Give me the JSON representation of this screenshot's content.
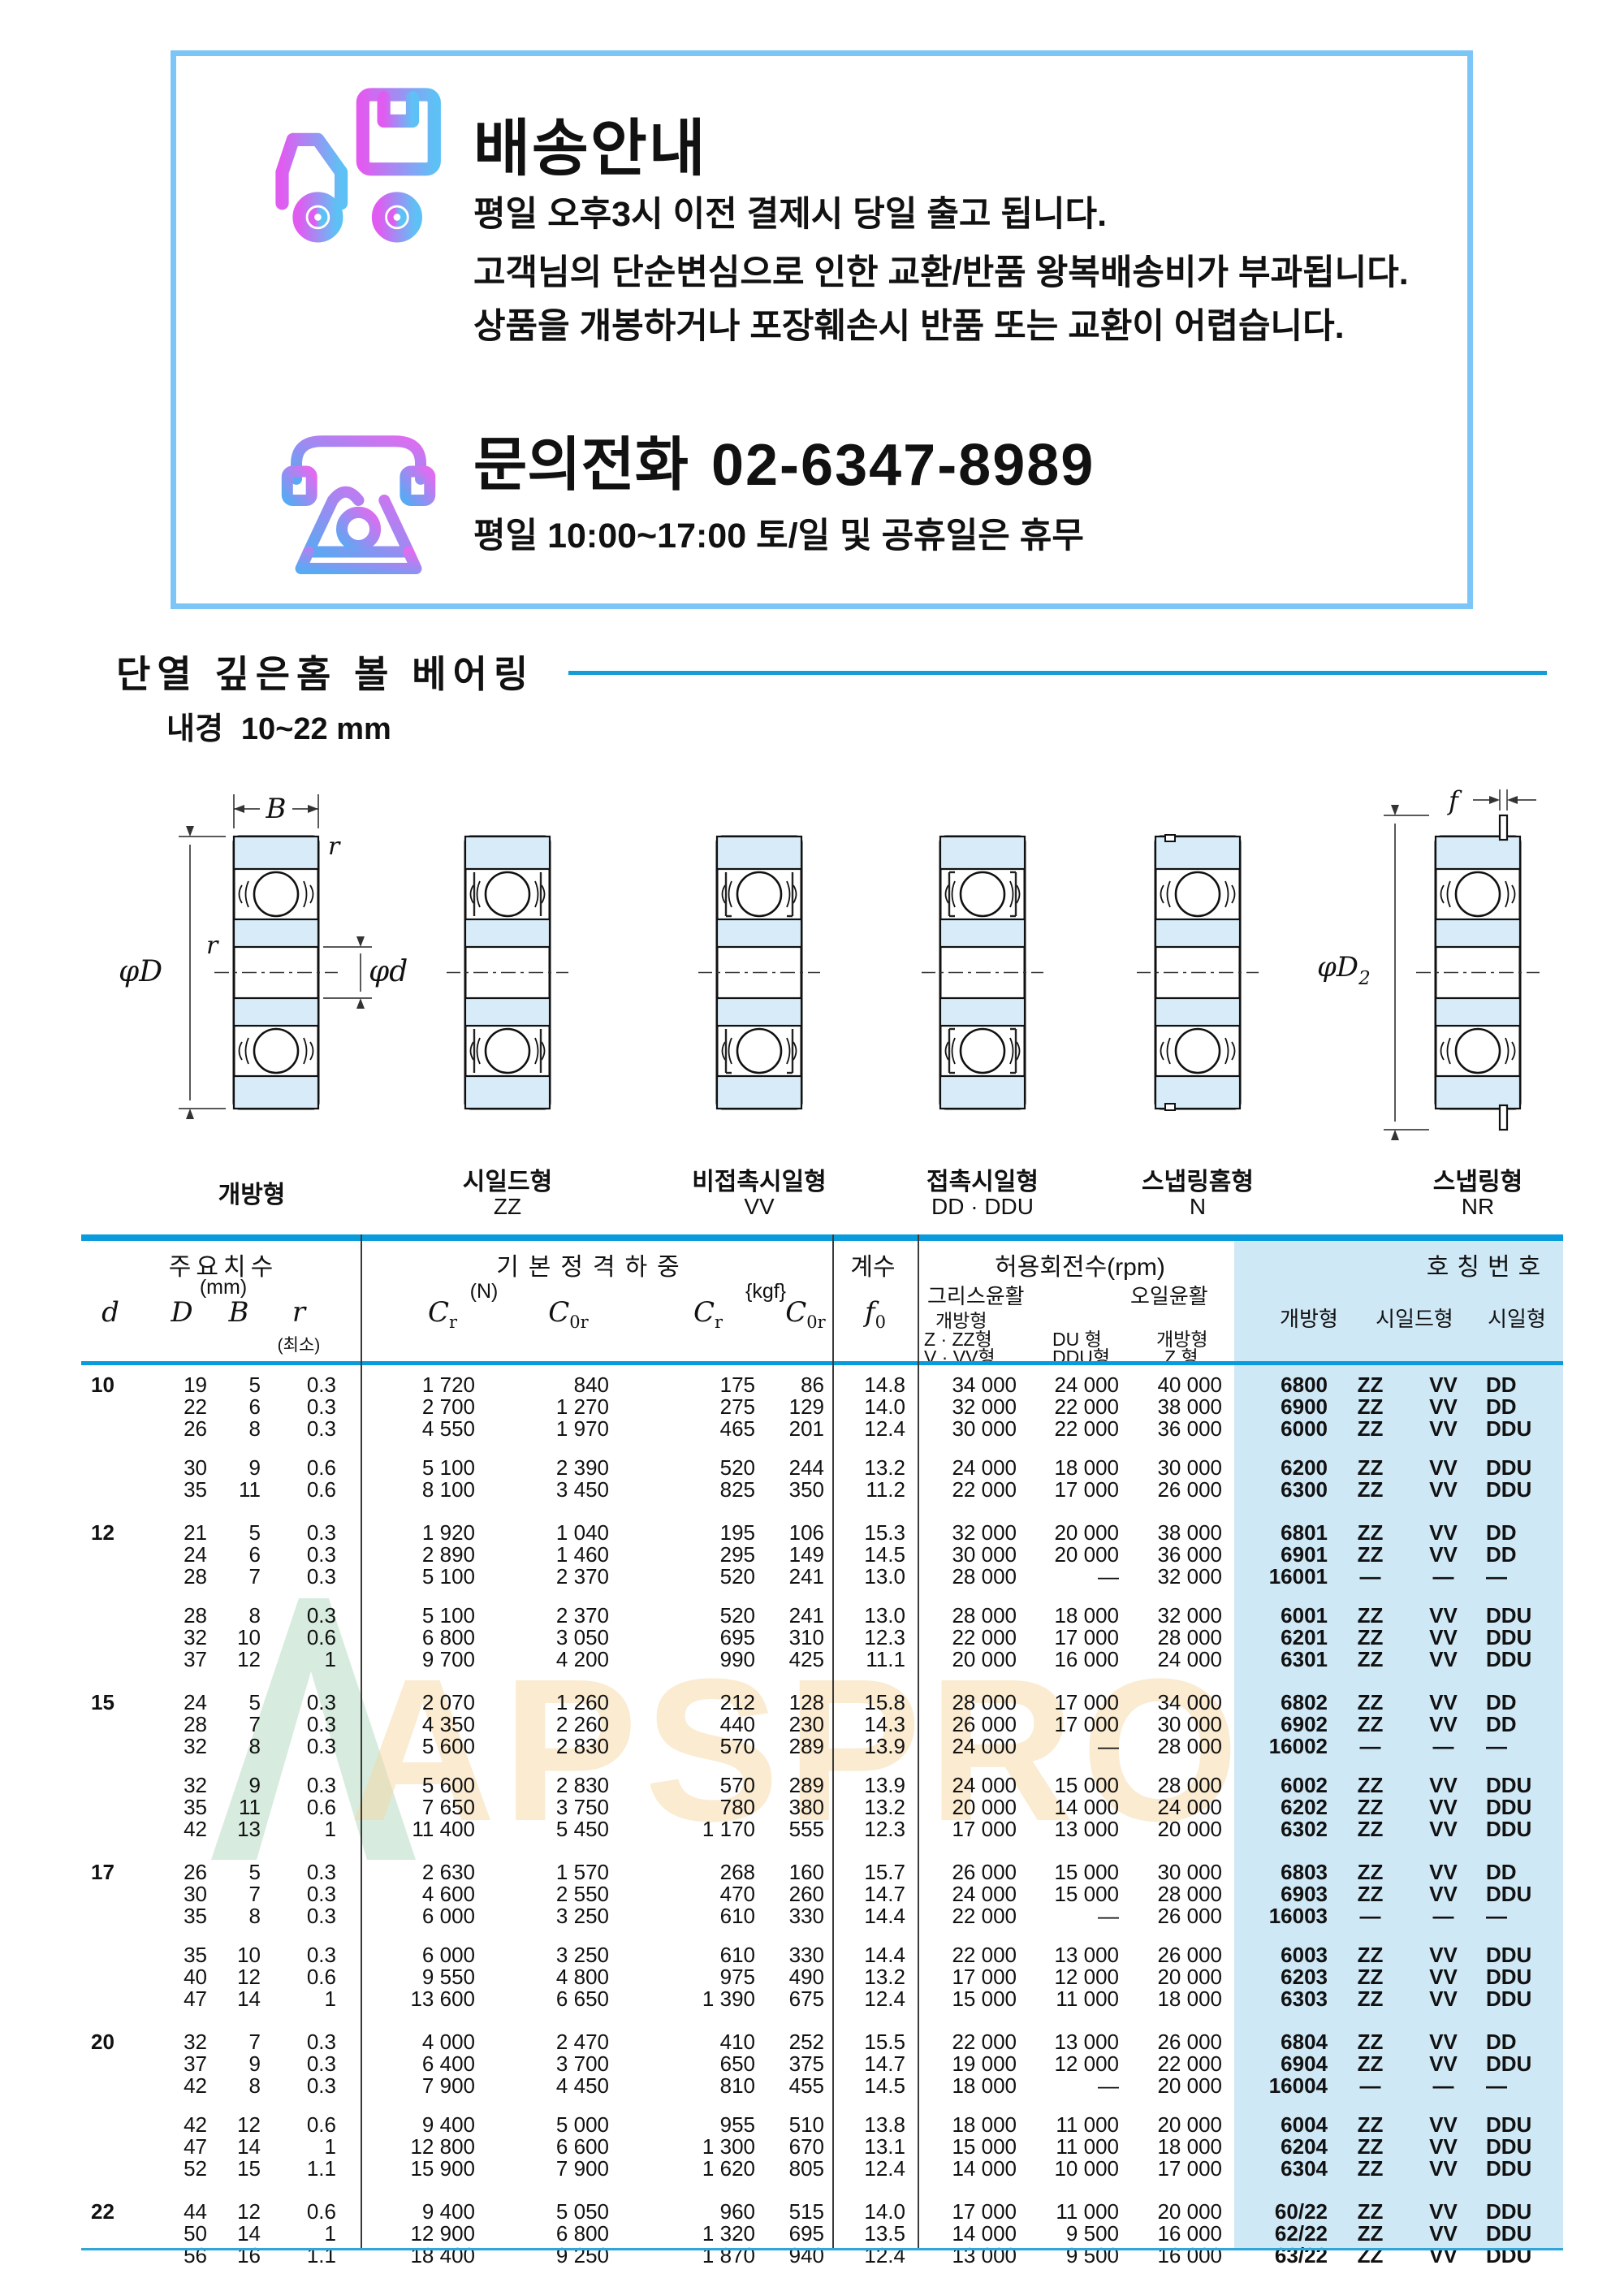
{
  "notice": {
    "title": "배송안내",
    "lines": [
      "평일 오후3시 이전 결제시 당일 출고 됩니다.",
      "고객님의 단순변심으로 인한 교환/반품 왕복배송비가 부과됩니다.",
      "상품을 개봉하거나 포장훼손시 반품 또는 교환이 어렵습니다."
    ],
    "phone_label": "문의전화",
    "phone_number": "02-6347-8989",
    "hours": "평일 10:00~17:00 토/일 및 공휴일은 휴무"
  },
  "section": {
    "title": "단열 깊은홈 볼 베어링",
    "bore_label": "내경",
    "bore_range": "10~22 mm"
  },
  "diagrams": [
    {
      "label": "개방형",
      "code": "",
      "type": "open"
    },
    {
      "label": "시일드형",
      "code": "ZZ",
      "type": "zz"
    },
    {
      "label": "비접촉시일형",
      "code": "VV",
      "type": "vv"
    },
    {
      "label": "접촉시일형",
      "code": "DD · DDU",
      "type": "dd"
    },
    {
      "label": "스냅링홈형",
      "code": "N",
      "type": "n"
    },
    {
      "label": "스냅링형",
      "code": "NR",
      "type": "nr"
    }
  ],
  "dim_labels": {
    "B": "B",
    "r": "r",
    "phiD": "φD",
    "phid": "φd",
    "f": "f",
    "phiD2": "φD",
    "phiD2_sub": "2"
  },
  "watermark": {
    "text": "APSPRO"
  },
  "colors": {
    "accent_blue": "#0a9bdc",
    "box_border": "#7cc6f7",
    "col_bg": "#cfe8f6",
    "bearing_fill": "#d7ebf8"
  },
  "table": {
    "h_dims": "주요치수",
    "h_dims_unit": "(mm)",
    "h_load": "기본정격하중",
    "h_load_n": "(N)",
    "h_load_kgf": "{kgf}",
    "h_factor": "계수",
    "h_speed": "허용회전수(rpm)",
    "h_grease": "그리스윤활",
    "h_oil": "오일윤활",
    "h_open": "개방형",
    "h_g1a": "Z · ZZ형",
    "h_g1b": "V · VV형",
    "h_g2a": "DU 형",
    "h_g2b": "DDU형",
    "h_o1": "개방형",
    "h_o2": "Z 형",
    "h_number": "호칭번호",
    "h_types": [
      "개방형",
      "시일드형",
      "시일형"
    ],
    "sym": {
      "d": "d",
      "D": "D",
      "B": "B",
      "r": "r",
      "r_min": "(최소)",
      "C": "C",
      "sub_r": "r",
      "sub_0r": "0r",
      "f": "f",
      "sub_0": "0"
    },
    "groups": [
      {
        "d": "10",
        "subs": [
          [
            [
              "19",
              "5",
              "0.3",
              "1 720",
              "840",
              "175",
              "86",
              "14.8",
              "34 000",
              "24 000",
              "40 000",
              "6800",
              "ZZ",
              "VV",
              "DD"
            ],
            [
              "22",
              "6",
              "0.3",
              "2 700",
              "1 270",
              "275",
              "129",
              "14.0",
              "32 000",
              "22 000",
              "38 000",
              "6900",
              "ZZ",
              "VV",
              "DD"
            ],
            [
              "26",
              "8",
              "0.3",
              "4 550",
              "1 970",
              "465",
              "201",
              "12.4",
              "30 000",
              "22 000",
              "36 000",
              "6000",
              "ZZ",
              "VV",
              "DDU"
            ]
          ],
          [
            [
              "30",
              "9",
              "0.6",
              "5 100",
              "2 390",
              "520",
              "244",
              "13.2",
              "24 000",
              "18 000",
              "30 000",
              "6200",
              "ZZ",
              "VV",
              "DDU"
            ],
            [
              "35",
              "11",
              "0.6",
              "8 100",
              "3 450",
              "825",
              "350",
              "11.2",
              "22 000",
              "17 000",
              "26 000",
              "6300",
              "ZZ",
              "VV",
              "DDU"
            ]
          ]
        ]
      },
      {
        "d": "12",
        "subs": [
          [
            [
              "21",
              "5",
              "0.3",
              "1 920",
              "1 040",
              "195",
              "106",
              "15.3",
              "32 000",
              "20 000",
              "38 000",
              "6801",
              "ZZ",
              "VV",
              "DD"
            ],
            [
              "24",
              "6",
              "0.3",
              "2 890",
              "1 460",
              "295",
              "149",
              "14.5",
              "30 000",
              "20 000",
              "36 000",
              "6901",
              "ZZ",
              "VV",
              "DD"
            ],
            [
              "28",
              "7",
              "0.3",
              "5 100",
              "2 370",
              "520",
              "241",
              "13.0",
              "28 000",
              "—",
              "32 000",
              "16001",
              "—",
              "—",
              "—"
            ]
          ],
          [
            [
              "28",
              "8",
              "0.3",
              "5 100",
              "2 370",
              "520",
              "241",
              "13.0",
              "28 000",
              "18 000",
              "32 000",
              "6001",
              "ZZ",
              "VV",
              "DDU"
            ],
            [
              "32",
              "10",
              "0.6",
              "6 800",
              "3 050",
              "695",
              "310",
              "12.3",
              "22 000",
              "17 000",
              "28 000",
              "6201",
              "ZZ",
              "VV",
              "DDU"
            ],
            [
              "37",
              "12",
              "1",
              "9 700",
              "4 200",
              "990",
              "425",
              "11.1",
              "20 000",
              "16 000",
              "24 000",
              "6301",
              "ZZ",
              "VV",
              "DDU"
            ]
          ]
        ]
      },
      {
        "d": "15",
        "subs": [
          [
            [
              "24",
              "5",
              "0.3",
              "2 070",
              "1 260",
              "212",
              "128",
              "15.8",
              "28 000",
              "17 000",
              "34 000",
              "6802",
              "ZZ",
              "VV",
              "DD"
            ],
            [
              "28",
              "7",
              "0.3",
              "4 350",
              "2 260",
              "440",
              "230",
              "14.3",
              "26 000",
              "17 000",
              "30 000",
              "6902",
              "ZZ",
              "VV",
              "DD"
            ],
            [
              "32",
              "8",
              "0.3",
              "5 600",
              "2 830",
              "570",
              "289",
              "13.9",
              "24 000",
              "—",
              "28 000",
              "16002",
              "—",
              "—",
              "—"
            ]
          ],
          [
            [
              "32",
              "9",
              "0.3",
              "5 600",
              "2 830",
              "570",
              "289",
              "13.9",
              "24 000",
              "15 000",
              "28 000",
              "6002",
              "ZZ",
              "VV",
              "DDU"
            ],
            [
              "35",
              "11",
              "0.6",
              "7 650",
              "3 750",
              "780",
              "380",
              "13.2",
              "20 000",
              "14 000",
              "24 000",
              "6202",
              "ZZ",
              "VV",
              "DDU"
            ],
            [
              "42",
              "13",
              "1",
              "11 400",
              "5 450",
              "1 170",
              "555",
              "12.3",
              "17 000",
              "13 000",
              "20 000",
              "6302",
              "ZZ",
              "VV",
              "DDU"
            ]
          ]
        ]
      },
      {
        "d": "17",
        "subs": [
          [
            [
              "26",
              "5",
              "0.3",
              "2 630",
              "1 570",
              "268",
              "160",
              "15.7",
              "26 000",
              "15 000",
              "30 000",
              "6803",
              "ZZ",
              "VV",
              "DD"
            ],
            [
              "30",
              "7",
              "0.3",
              "4 600",
              "2 550",
              "470",
              "260",
              "14.7",
              "24 000",
              "15 000",
              "28 000",
              "6903",
              "ZZ",
              "VV",
              "DDU"
            ],
            [
              "35",
              "8",
              "0.3",
              "6 000",
              "3 250",
              "610",
              "330",
              "14.4",
              "22 000",
              "—",
              "26 000",
              "16003",
              "—",
              "—",
              "—"
            ]
          ],
          [
            [
              "35",
              "10",
              "0.3",
              "6 000",
              "3 250",
              "610",
              "330",
              "14.4",
              "22 000",
              "13 000",
              "26 000",
              "6003",
              "ZZ",
              "VV",
              "DDU"
            ],
            [
              "40",
              "12",
              "0.6",
              "9 550",
              "4 800",
              "975",
              "490",
              "13.2",
              "17 000",
              "12 000",
              "20 000",
              "6203",
              "ZZ",
              "VV",
              "DDU"
            ],
            [
              "47",
              "14",
              "1",
              "13 600",
              "6 650",
              "1 390",
              "675",
              "12.4",
              "15 000",
              "11 000",
              "18 000",
              "6303",
              "ZZ",
              "VV",
              "DDU"
            ]
          ]
        ]
      },
      {
        "d": "20",
        "subs": [
          [
            [
              "32",
              "7",
              "0.3",
              "4 000",
              "2 470",
              "410",
              "252",
              "15.5",
              "22 000",
              "13 000",
              "26 000",
              "6804",
              "ZZ",
              "VV",
              "DD"
            ],
            [
              "37",
              "9",
              "0.3",
              "6 400",
              "3 700",
              "650",
              "375",
              "14.7",
              "19 000",
              "12 000",
              "22 000",
              "6904",
              "ZZ",
              "VV",
              "DDU"
            ],
            [
              "42",
              "8",
              "0.3",
              "7 900",
              "4 450",
              "810",
              "455",
              "14.5",
              "18 000",
              "—",
              "20 000",
              "16004",
              "—",
              "—",
              "—"
            ]
          ],
          [
            [
              "42",
              "12",
              "0.6",
              "9 400",
              "5 000",
              "955",
              "510",
              "13.8",
              "18 000",
              "11 000",
              "20 000",
              "6004",
              "ZZ",
              "VV",
              "DDU"
            ],
            [
              "47",
              "14",
              "1",
              "12 800",
              "6 600",
              "1 300",
              "670",
              "13.1",
              "15 000",
              "11 000",
              "18 000",
              "6204",
              "ZZ",
              "VV",
              "DDU"
            ],
            [
              "52",
              "15",
              "1.1",
              "15 900",
              "7 900",
              "1 620",
              "805",
              "12.4",
              "14 000",
              "10 000",
              "17 000",
              "6304",
              "ZZ",
              "VV",
              "DDU"
            ]
          ]
        ]
      },
      {
        "d": "22",
        "subs": [
          [
            [
              "44",
              "12",
              "0.6",
              "9 400",
              "5 050",
              "960",
              "515",
              "14.0",
              "17 000",
              "11 000",
              "20 000",
              "60/22",
              "ZZ",
              "VV",
              "DDU"
            ],
            [
              "50",
              "14",
              "1",
              "12 900",
              "6 800",
              "1 320",
              "695",
              "13.5",
              "14 000",
              "9 500",
              "16 000",
              "62/22",
              "ZZ",
              "VV",
              "DDU"
            ],
            [
              "56",
              "16",
              "1.1",
              "18 400",
              "9 250",
              "1 870",
              "940",
              "12.4",
              "13 000",
              "9 500",
              "16 000",
              "63/22",
              "ZZ",
              "VV",
              "DDU"
            ]
          ]
        ]
      }
    ]
  }
}
